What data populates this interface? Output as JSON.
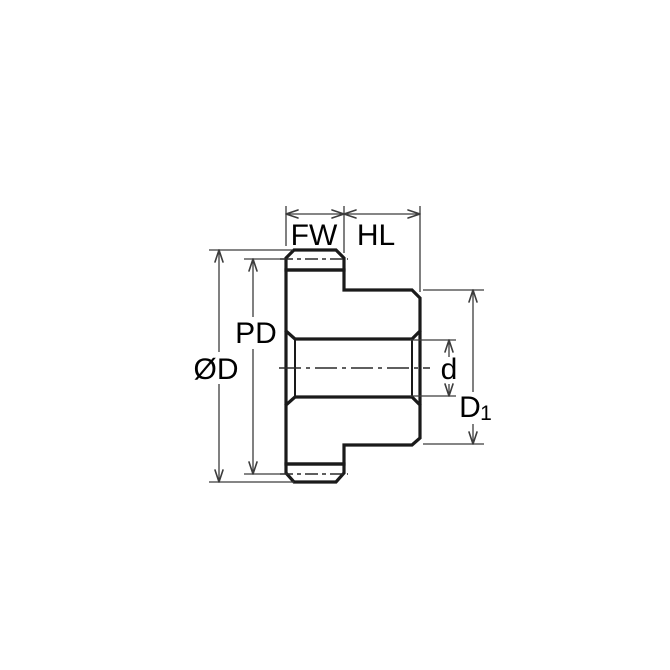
{
  "diagram": {
    "labels": {
      "face_width": "FW",
      "hub_length": "HL",
      "pitch_diameter": "PD",
      "outer_diameter": "ØD",
      "bore_diameter": "d",
      "hub_diameter_main": "D",
      "hub_diameter_sub": "1"
    },
    "colors": {
      "part_fill": "#C5E6F6",
      "outline": "#1A1A1A",
      "dimension_lines": "#3C3C3C",
      "background": "#FFFFFF",
      "text": "#000000"
    }
  }
}
